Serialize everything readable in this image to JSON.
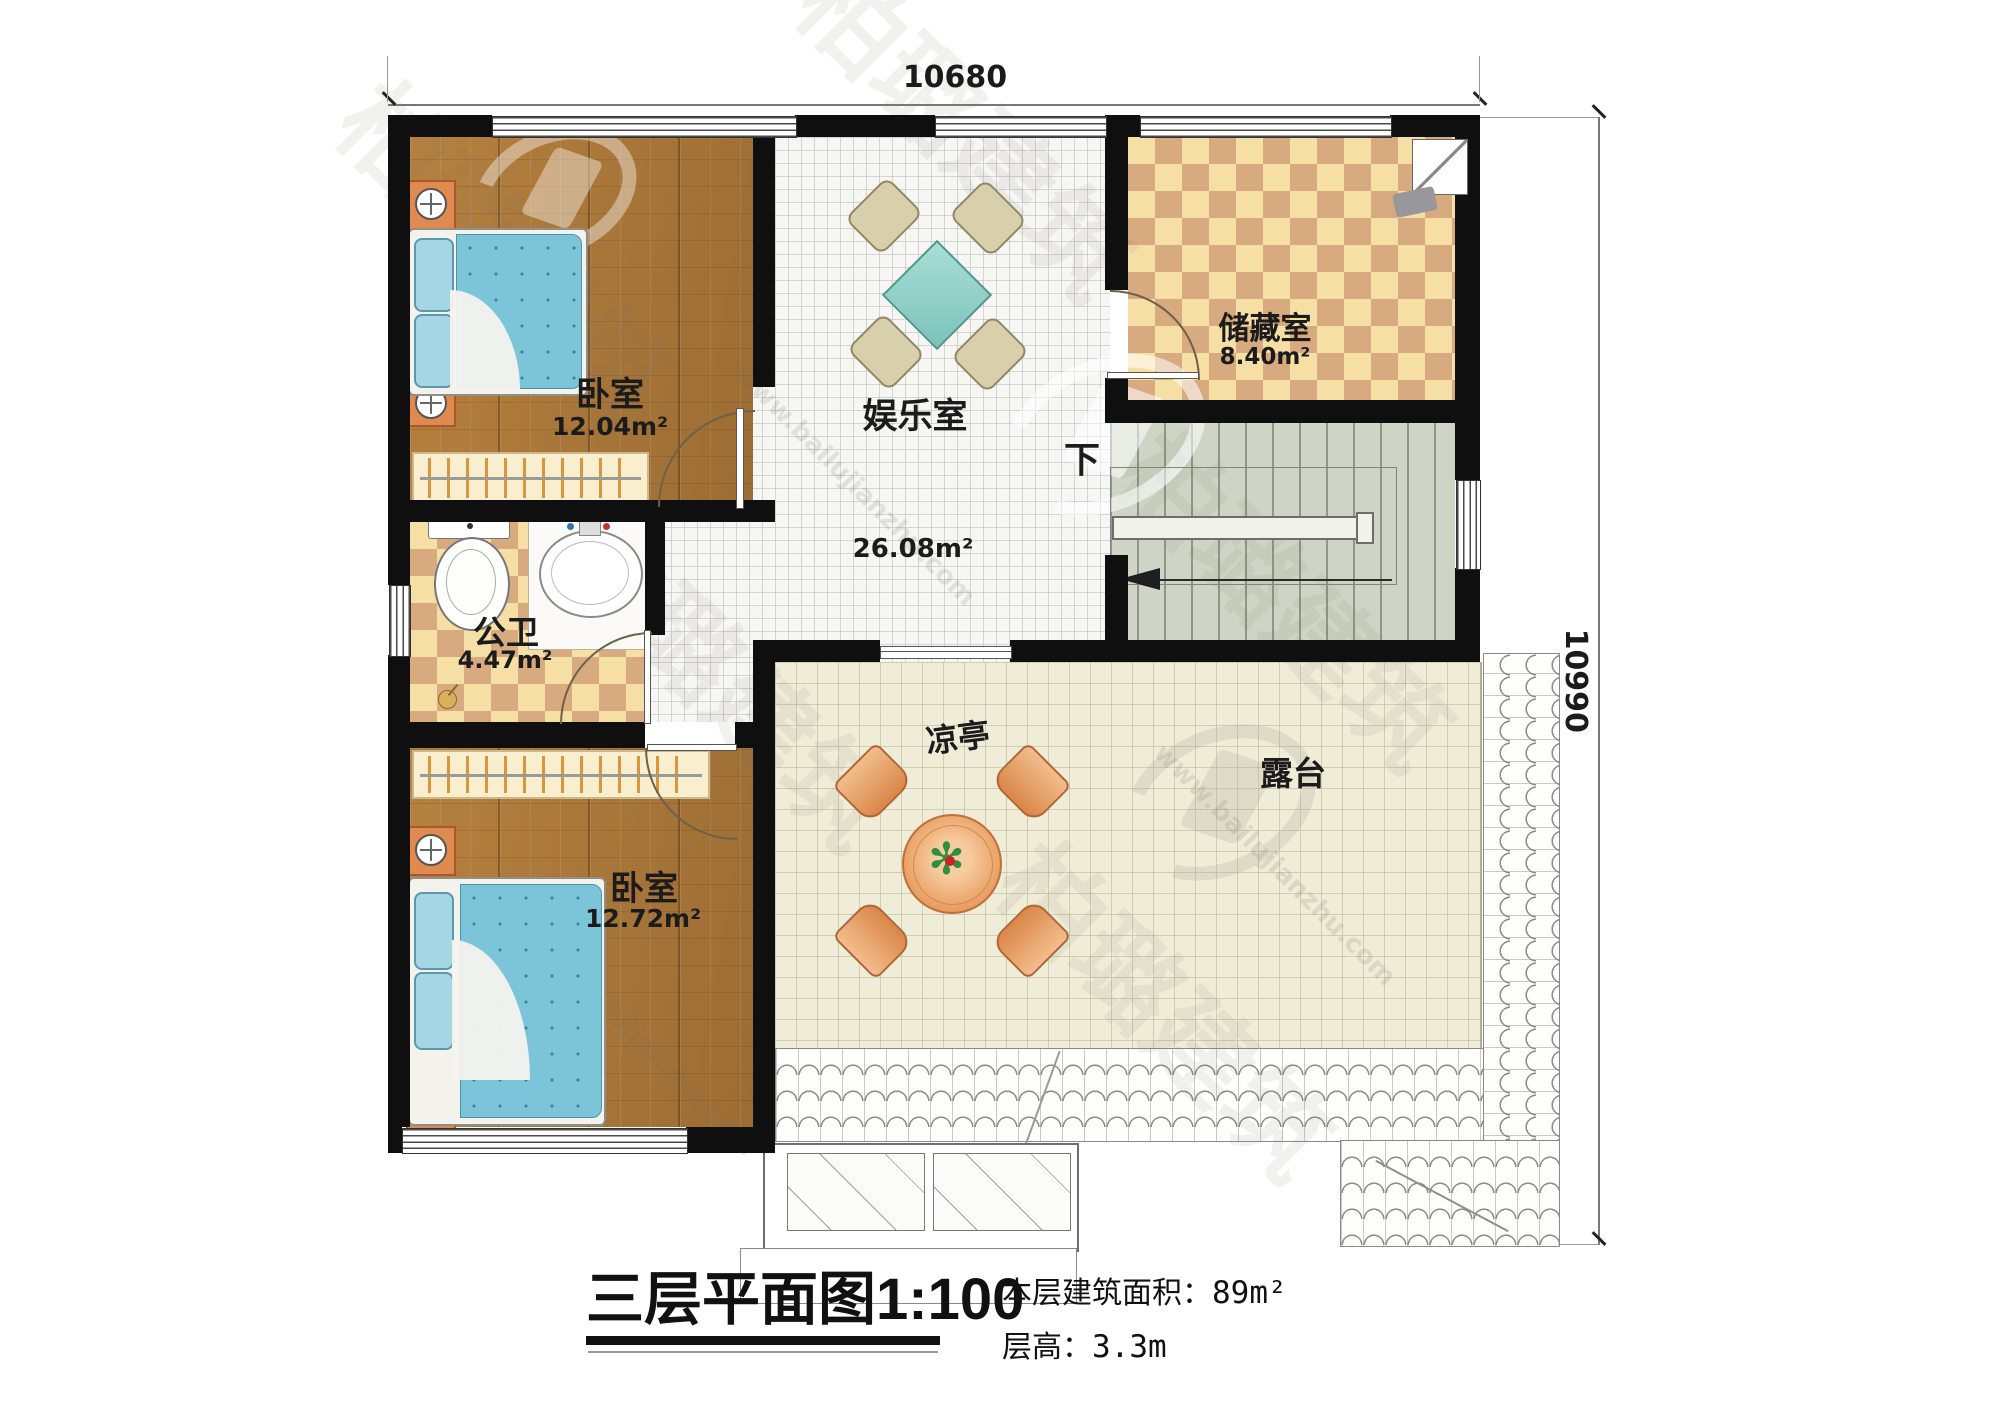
{
  "plan": {
    "dimensions": {
      "top": "10680",
      "right": "10990"
    },
    "rooms": [
      {
        "name": "卧室",
        "area": "12.04m²"
      },
      {
        "name": "娱乐室",
        "area": "26.08m²"
      },
      {
        "name": "储藏室",
        "area": "8.40m²"
      },
      {
        "name": "公卫",
        "area": "4.47m²"
      },
      {
        "name": "卧室",
        "area": "12.72m²"
      },
      {
        "name": "凉亭"
      },
      {
        "name": "露台"
      }
    ],
    "stairs": {
      "direction_label": "下"
    }
  },
  "title_block": {
    "title": "三层平面图",
    "scale": "1:100",
    "area_label": "本层建筑面积：",
    "area_value": "89m²",
    "height_label": "层高：",
    "height_value": "3.3m"
  },
  "watermark": {
    "brand": "柏璐建筑",
    "url": "www.bailujianzhu.com"
  },
  "colors": {
    "wall": "#0f0f0f",
    "wood_floor": "#a9773d",
    "tile_light": "#f6dfa5",
    "tile_dark": "#d7ab7f",
    "stair_floor": "#ced5c6",
    "terrace_floor": "#efecd8",
    "bed_blanket": "#7cc5d9",
    "table_orange": "#e8995c"
  }
}
